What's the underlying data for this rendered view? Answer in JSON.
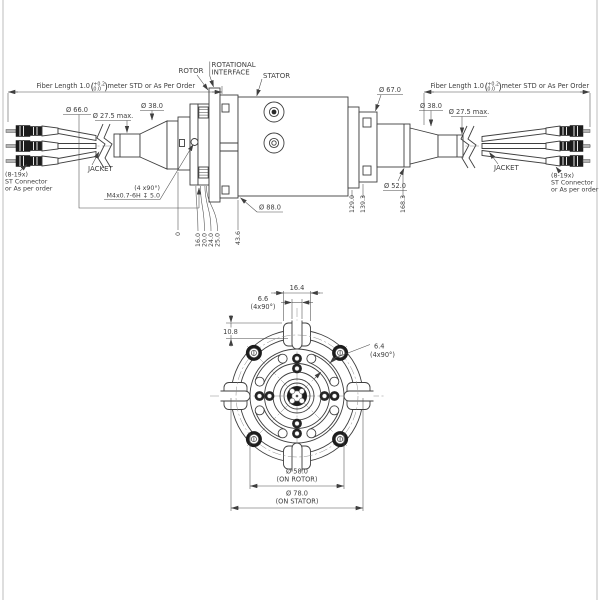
{
  "colors": {
    "line": "#3f3f3f",
    "text": "#3d3d3d",
    "dark_fill": "#1b1b1b"
  },
  "side_view": {
    "labels": {
      "rotor": "ROTOR",
      "rotational_1": "ROTATIONAL",
      "rotational_2": "INTERFACE",
      "stator": "STATOR",
      "jacket": "JACKET"
    },
    "fiber_dim": {
      "prefix": "Fiber Length 1.0",
      "paren_open": "(",
      "paren_close": ")",
      "tol_top": "+0.2",
      "tol_bottom": "0.0",
      "suffix": "meter STD or As Per Order"
    },
    "connector_note": {
      "line1": "(8-19x)",
      "line2": "ST Connector",
      "line3": "or As per order"
    },
    "thread_note": {
      "line1": "(4 x90°)",
      "line2": "M4x0.7-6H ↧ 5.0"
    },
    "diameters": {
      "d66": "Ø 66.0",
      "d27_left": "Ø 27.5 max.",
      "d38_left": "Ø 38.0",
      "d88": "Ø 88.0",
      "d67": "Ø 67.0",
      "d38_right": "Ø 38.0",
      "d27_right": "Ø 27.5 max.",
      "d52": "Ø 52.0"
    },
    "ordinates": [
      "0",
      "16.0",
      "20.0",
      "24.0",
      "25.0",
      "43.6",
      "129.0",
      "139.3",
      "168.3"
    ]
  },
  "front_view": {
    "dims": {
      "w16": "16.4",
      "s66_1": "6.6",
      "s66_2": "(4x90°)",
      "h108": "10.8",
      "s64_1": "6.4",
      "s64_2": "(4x90°)",
      "d58": "Ø 58.0",
      "d58_note": "(ON ROTOR)",
      "d78": "Ø 78.0",
      "d78_note": "(ON STATOR)"
    }
  }
}
